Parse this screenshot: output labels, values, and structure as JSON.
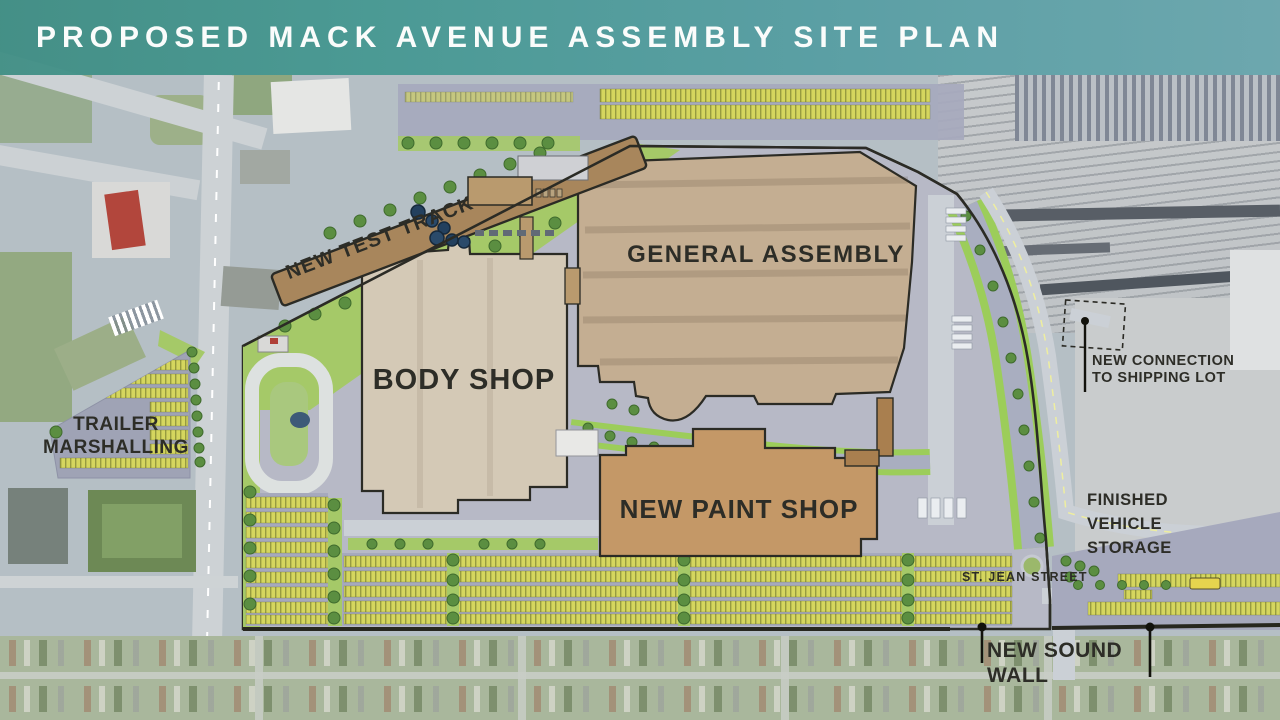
{
  "title": "PROPOSED MACK AVENUE ASSEMBLY SITE PLAN",
  "site_labels": {
    "test_track": "NEW TEST TRACK",
    "general_assembly": "GENERAL ASSEMBLY",
    "body_shop": "BODY SHOP",
    "paint_shop": "NEW PAINT SHOP",
    "trailer_marshalling": "TRAILER\nMARSHALLING",
    "shipping_connection": "NEW CONNECTION\nTO SHIPPING LOT",
    "finished_vehicle_storage": "FINISHED\nVEHICLE\nSTORAGE",
    "st_jean_street": "ST. JEAN STREET",
    "sound_wall": "NEW SOUND WALL"
  },
  "colors": {
    "banner-teal-left": "#35897e",
    "banner-teal-right": "#63a4ab",
    "title-text": "#fafcfb",
    "label-ink": "#2d2d27",
    "building-ga": "#c4ae92",
    "building-body-shop": "#d4c9b6",
    "building-paint-shop": "#c49867",
    "test-track": "#a8865c",
    "outline": "#2b2b25",
    "landscape-green": "#a5c968",
    "tree-green": "#5b8e41",
    "parking-lot": "#a6a9bd",
    "parking-stripe-yellow": "#d5d65e",
    "site-paving": "#b7b9c6",
    "road": "#cbd0d6",
    "water": "#a9aec0",
    "leader-line": "#12120c"
  }
}
